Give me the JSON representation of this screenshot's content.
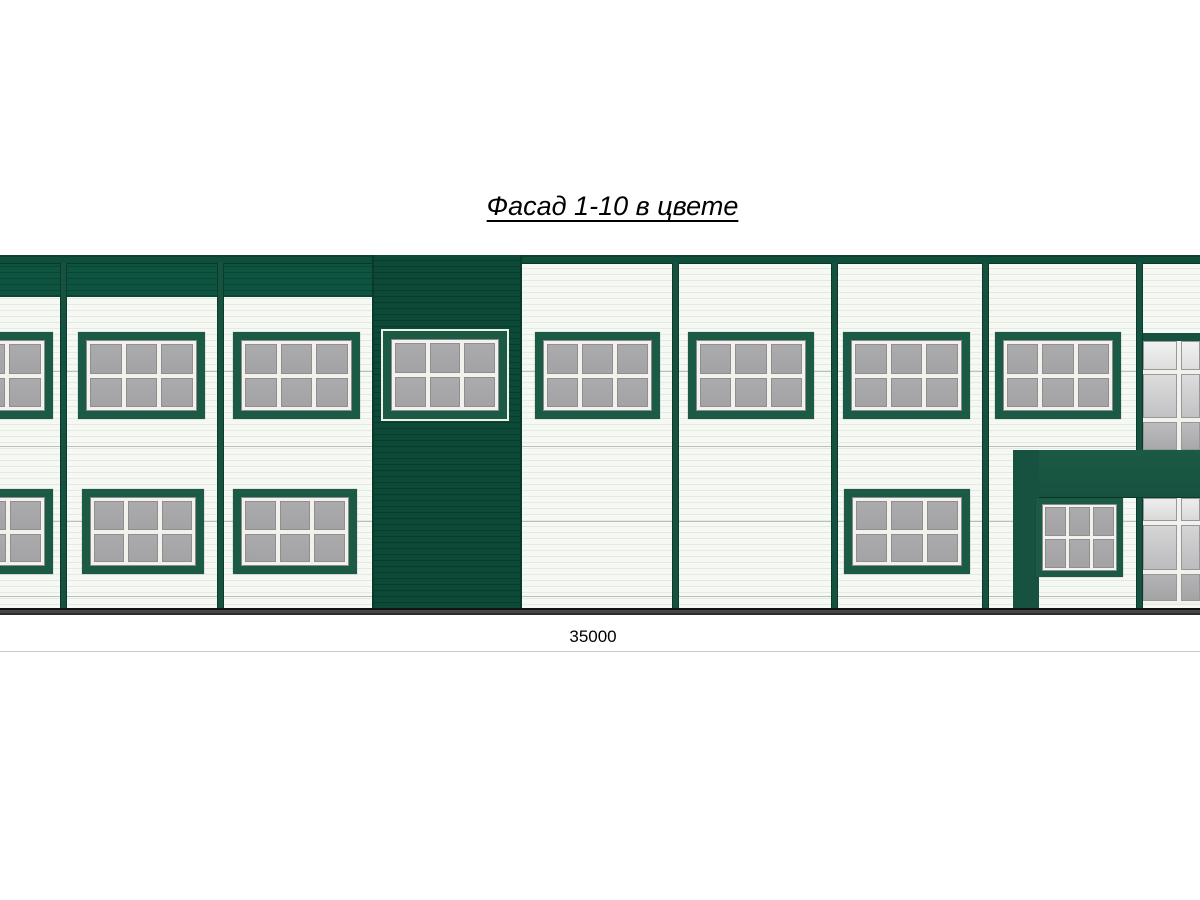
{
  "title": {
    "text": "Фасад 1-10 в цвете"
  },
  "dimension": {
    "label": "35000"
  },
  "colors": {
    "green_band": "#0f5440",
    "green_band_rib": "#0a4534",
    "green_dark": "#0c4a37",
    "green_dark_rib": "#083b2c",
    "green_frame": "#1b5a45",
    "green_element": "#16523f",
    "green_coping": "#104e3c",
    "green_coping_edge": "#0d4231",
    "green_edge": "#0a3c2d",
    "wall": "#f5f8f3",
    "wall_line": "#e2eae1",
    "wall_joint": "#b9bfb9",
    "glass": "#a7a7a9",
    "glass_edge": "#8f8f91",
    "sash": "#f2f1ec",
    "ground": "#45484b",
    "ground_edge": "#141414",
    "dim_line": "#c9c9c9"
  },
  "facade": {
    "wall": {
      "x": 0,
      "y": 263,
      "w": 1200,
      "h": 345
    },
    "parapet_band": {
      "x": 0,
      "y": 255,
      "w": 522,
      "h": 42
    },
    "band_seams_x": [
      63,
      220
    ],
    "coping": {
      "x": 0,
      "y": 255,
      "w": 1200,
      "h": 9
    },
    "dark_bay": {
      "x": 372,
      "y": 255,
      "w": 150,
      "h": 353
    },
    "pilasters_x": [
      60,
      217,
      672,
      831,
      982,
      1136
    ],
    "pilaster": {
      "y": 263,
      "w": 7,
      "h": 345
    },
    "windows": [
      {
        "kind": "upper-window",
        "style": "green",
        "x": -74,
        "y": 332,
        "w": 127,
        "h": 87
      },
      {
        "kind": "upper-window",
        "style": "green",
        "x": 78,
        "y": 332,
        "w": 127,
        "h": 87
      },
      {
        "kind": "upper-window",
        "style": "green",
        "x": 233,
        "y": 332,
        "w": 127,
        "h": 87
      },
      {
        "kind": "upper-window",
        "style": "outlined",
        "x": 383,
        "y": 331,
        "w": 124,
        "h": 88
      },
      {
        "kind": "upper-window",
        "style": "green",
        "x": 535,
        "y": 332,
        "w": 125,
        "h": 87
      },
      {
        "kind": "upper-window",
        "style": "green",
        "x": 688,
        "y": 332,
        "w": 126,
        "h": 87
      },
      {
        "kind": "upper-window",
        "style": "green",
        "x": 843,
        "y": 332,
        "w": 127,
        "h": 87
      },
      {
        "kind": "upper-window",
        "style": "green",
        "x": 995,
        "y": 332,
        "w": 126,
        "h": 87
      },
      {
        "kind": "lower-window",
        "style": "green",
        "x": -73,
        "y": 489,
        "w": 126,
        "h": 85
      },
      {
        "kind": "lower-window",
        "style": "green",
        "x": 82,
        "y": 489,
        "w": 122,
        "h": 85
      },
      {
        "kind": "lower-window",
        "style": "green",
        "x": 233,
        "y": 489,
        "w": 124,
        "h": 85
      },
      {
        "kind": "lower-window",
        "style": "green",
        "x": 844,
        "y": 489,
        "w": 126,
        "h": 85
      },
      {
        "kind": "entrance-window",
        "style": "compact",
        "x": 1036,
        "y": 498,
        "w": 87,
        "h": 79
      }
    ],
    "entrance": {
      "beam": {
        "x": 1013,
        "y": 450,
        "w": 187,
        "h": 48
      },
      "column": {
        "x": 1013,
        "y": 450,
        "w": 26,
        "h": 158
      }
    },
    "curtain_wall": {
      "x": 1143,
      "w": 57,
      "header": {
        "y": 333,
        "h": 8
      },
      "top": {
        "y": 341,
        "h": 109,
        "rows": [
          29,
          44,
          28
        ],
        "row_class_base": 0
      },
      "bottom": {
        "y": 498,
        "h": 106,
        "rows": [
          23,
          45,
          27
        ],
        "row_class_base": 3,
        "sill": 3
      }
    },
    "ground": {
      "x": 0,
      "y": 608,
      "w": 1200,
      "h": 7
    }
  }
}
